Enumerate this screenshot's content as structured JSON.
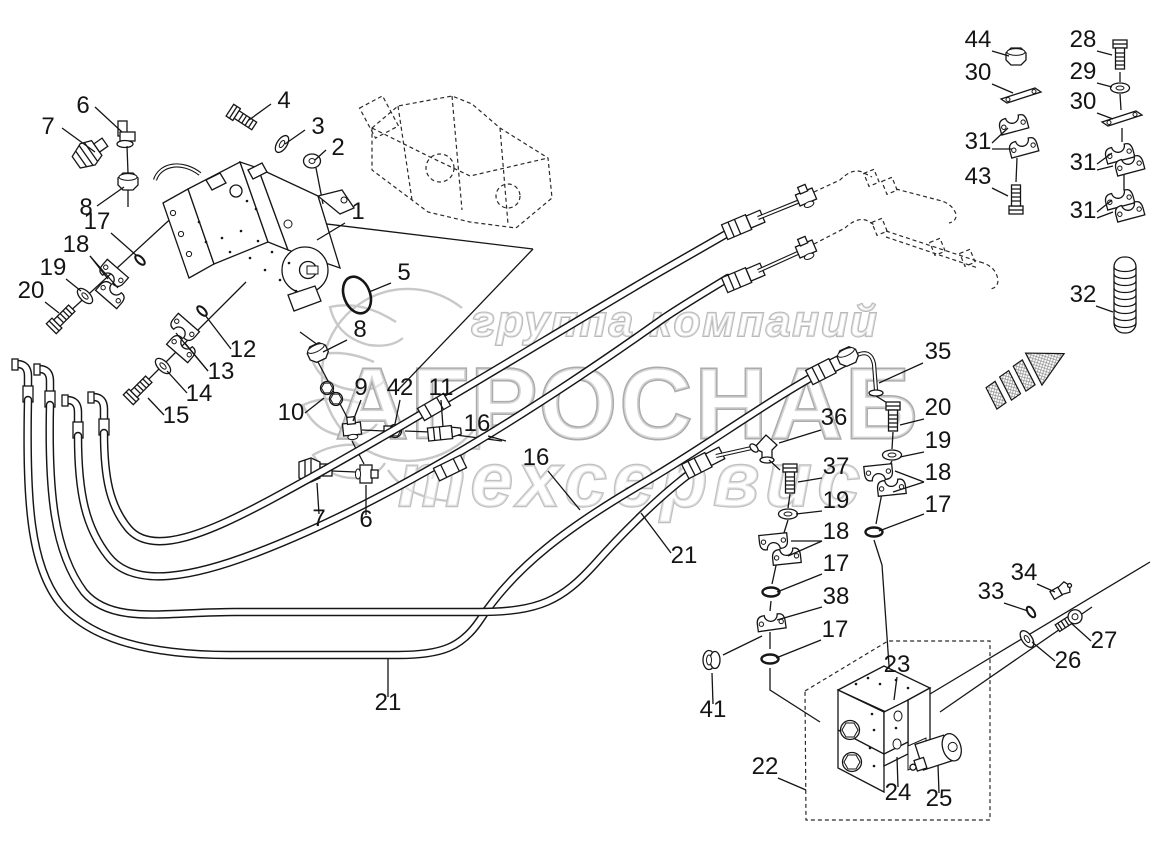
{
  "watermark": {
    "line1": "группа компаний",
    "line2": "АГРОСНАБ",
    "line3": "техсервис",
    "logo_icon": "wheat-gear-logo",
    "color": "#bdbdbd"
  },
  "diagram": {
    "background": "#ffffff",
    "line_color": "#161616",
    "direction_arrow_icon": "hatched-arrow-up-right",
    "callouts": [
      {
        "label": "7",
        "x": 48,
        "y": 134,
        "leaders": [
          [
            [
              62,
              128
            ],
            [
              95,
              152
            ]
          ]
        ]
      },
      {
        "label": "6",
        "x": 83,
        "y": 113,
        "leaders": [
          [
            [
              95,
              107
            ],
            [
              122,
              132
            ]
          ]
        ]
      },
      {
        "label": "4",
        "x": 284,
        "y": 108,
        "leaders": [
          [
            [
              271,
              104
            ],
            [
              249,
              120
            ]
          ]
        ]
      },
      {
        "label": "3",
        "x": 318,
        "y": 134,
        "leaders": [
          [
            [
              305,
              130
            ],
            [
              285,
              144
            ]
          ]
        ]
      },
      {
        "label": "2",
        "x": 338,
        "y": 155,
        "leaders": [
          [
            [
              326,
              150
            ],
            [
              315,
              160
            ]
          ]
        ]
      },
      {
        "label": "8",
        "x": 86,
        "y": 215,
        "leaders": [
          [
            [
              97,
              206
            ],
            [
              124,
              187
            ]
          ]
        ]
      },
      {
        "label": "17",
        "x": 97,
        "y": 229,
        "leaders": [
          [
            [
              111,
              233
            ],
            [
              137,
              256
            ]
          ]
        ]
      },
      {
        "label": "18",
        "x": 76,
        "y": 252,
        "leaders": [
          [
            [
              90,
              256
            ],
            [
              108,
              279
            ]
          ],
          [
            [
              90,
              256
            ],
            [
              118,
              288
            ]
          ]
        ]
      },
      {
        "label": "19",
        "x": 53,
        "y": 275,
        "leaders": [
          [
            [
              66,
              279
            ],
            [
              81,
              291
            ]
          ]
        ]
      },
      {
        "label": "20",
        "x": 31,
        "y": 298,
        "leaders": [
          [
            [
              45,
              302
            ],
            [
              59,
              313
            ]
          ]
        ]
      },
      {
        "label": "1",
        "x": 358,
        "y": 219,
        "leaders": [
          [
            [
              345,
              223
            ],
            [
              317,
              240
            ]
          ]
        ]
      },
      {
        "label": "5",
        "x": 404,
        "y": 280,
        "leaders": [
          [
            [
              391,
              283
            ],
            [
              369,
              292
            ]
          ]
        ]
      },
      {
        "label": "8",
        "x": 360,
        "y": 337,
        "leaders": [
          [
            [
              347,
              340
            ],
            [
              323,
              352
            ]
          ]
        ]
      },
      {
        "label": "12",
        "x": 243,
        "y": 357,
        "leaders": [
          [
            [
              231,
              349
            ],
            [
              205,
              315
            ]
          ]
        ]
      },
      {
        "label": "13",
        "x": 221,
        "y": 379,
        "leaders": [
          [
            [
              208,
              371
            ],
            [
              185,
              343
            ]
          ],
          [
            [
              208,
              371
            ],
            [
              176,
              333
            ]
          ]
        ]
      },
      {
        "label": "14",
        "x": 199,
        "y": 401,
        "leaders": [
          [
            [
              187,
              393
            ],
            [
              167,
              371
            ]
          ]
        ]
      },
      {
        "label": "15",
        "x": 176,
        "y": 423,
        "leaders": [
          [
            [
              164,
              415
            ],
            [
              148,
              398
            ]
          ]
        ]
      },
      {
        "label": "10",
        "x": 291,
        "y": 420,
        "leaders": [
          [
            [
              305,
              413
            ],
            [
              324,
              398
            ]
          ]
        ]
      },
      {
        "label": "9",
        "x": 361,
        "y": 395,
        "leaders": [
          [
            [
              361,
              400
            ],
            [
              353,
              421
            ]
          ]
        ]
      },
      {
        "label": "42",
        "x": 400,
        "y": 395,
        "leaders": [
          [
            [
              400,
              400
            ],
            [
              395,
              424
            ]
          ]
        ]
      },
      {
        "label": "11",
        "x": 441,
        "y": 395,
        "leaders": [
          [
            [
              441,
              400
            ],
            [
              443,
              427
            ]
          ]
        ]
      },
      {
        "label": "16",
        "x": 477,
        "y": 431,
        "leaders": [
          [
            [
              488,
              436
            ],
            [
              506,
              441
            ]
          ]
        ]
      },
      {
        "label": "16",
        "x": 536,
        "y": 465,
        "leaders": [
          [
            [
              548,
              471
            ],
            [
              580,
              510
            ]
          ]
        ]
      },
      {
        "label": "7",
        "x": 319,
        "y": 526,
        "leaders": [
          [
            [
              319,
              514
            ],
            [
              317,
              483
            ]
          ]
        ]
      },
      {
        "label": "6",
        "x": 366,
        "y": 527,
        "leaders": [
          [
            [
              366,
              515
            ],
            [
              366,
              485
            ]
          ]
        ]
      },
      {
        "label": "21",
        "x": 684,
        "y": 563,
        "leaders": [
          [
            [
              671,
              553
            ],
            [
              641,
              513
            ]
          ]
        ]
      },
      {
        "label": "21",
        "x": 388,
        "y": 710,
        "leaders": [
          [
            [
              388,
              697
            ],
            [
              388,
              659
            ]
          ]
        ]
      },
      {
        "label": "35",
        "x": 938,
        "y": 359,
        "leaders": [
          [
            [
              923,
              363
            ],
            [
              879,
              383
            ]
          ]
        ]
      },
      {
        "label": "36",
        "x": 834,
        "y": 425,
        "leaders": [
          [
            [
              821,
              430
            ],
            [
              779,
              443
            ]
          ]
        ]
      },
      {
        "label": "20",
        "x": 938,
        "y": 415,
        "leaders": [
          [
            [
              924,
              419
            ],
            [
              900,
              425
            ]
          ]
        ]
      },
      {
        "label": "19",
        "x": 938,
        "y": 448,
        "leaders": [
          [
            [
              924,
              452
            ],
            [
              900,
              457
            ]
          ]
        ]
      },
      {
        "label": "18",
        "x": 938,
        "y": 480,
        "leaders": [
          [
            [
              924,
              482
            ],
            [
              895,
              471
            ]
          ],
          [
            [
              924,
              482
            ],
            [
              893,
              492
            ]
          ]
        ]
      },
      {
        "label": "17",
        "x": 938,
        "y": 512,
        "leaders": [
          [
            [
              924,
              514
            ],
            [
              879,
              531
            ]
          ]
        ]
      },
      {
        "label": "37",
        "x": 836,
        "y": 474,
        "leaders": [
          [
            [
              822,
              478
            ],
            [
              798,
              482
            ]
          ]
        ]
      },
      {
        "label": "19",
        "x": 836,
        "y": 508,
        "leaders": [
          [
            [
              822,
              511
            ],
            [
              796,
              514
            ]
          ]
        ]
      },
      {
        "label": "18",
        "x": 836,
        "y": 539,
        "leaders": [
          [
            [
              822,
              541
            ],
            [
              791,
              541
            ]
          ],
          [
            [
              822,
              541
            ],
            [
              788,
              556
            ]
          ]
        ]
      },
      {
        "label": "17",
        "x": 836,
        "y": 571,
        "leaders": [
          [
            [
              822,
              574
            ],
            [
              777,
              592
            ]
          ]
        ]
      },
      {
        "label": "38",
        "x": 836,
        "y": 604,
        "leaders": [
          [
            [
              822,
              607
            ],
            [
              777,
              620
            ]
          ]
        ]
      },
      {
        "label": "17",
        "x": 835,
        "y": 637,
        "leaders": [
          [
            [
              821,
              640
            ],
            [
              776,
              658
            ]
          ]
        ]
      },
      {
        "label": "41",
        "x": 713,
        "y": 717,
        "leaders": [
          [
            [
              713,
              704
            ],
            [
              712,
              673
            ]
          ]
        ]
      },
      {
        "label": "22",
        "x": 765,
        "y": 774,
        "leaders": [
          [
            [
              778,
              778
            ],
            [
              806,
              790
            ]
          ]
        ]
      },
      {
        "label": "23",
        "x": 897,
        "y": 672,
        "leaders": [
          [
            [
              897,
              677
            ],
            [
              894,
              700
            ]
          ]
        ]
      },
      {
        "label": "24",
        "x": 898,
        "y": 800,
        "leaders": [
          [
            [
              898,
              787
            ],
            [
              897,
              757
            ]
          ]
        ]
      },
      {
        "label": "25",
        "x": 939,
        "y": 806,
        "leaders": [
          [
            [
              939,
              793
            ],
            [
              938,
              765
            ]
          ]
        ]
      },
      {
        "label": "33",
        "x": 991,
        "y": 599,
        "leaders": [
          [
            [
              1004,
              603
            ],
            [
              1028,
              611
            ]
          ]
        ]
      },
      {
        "label": "34",
        "x": 1024,
        "y": 580,
        "leaders": [
          [
            [
              1037,
              584
            ],
            [
              1055,
              592
            ]
          ]
        ]
      },
      {
        "label": "27",
        "x": 1104,
        "y": 648,
        "leaders": [
          [
            [
              1091,
              641
            ],
            [
              1071,
              623
            ]
          ]
        ]
      },
      {
        "label": "26",
        "x": 1068,
        "y": 668,
        "leaders": [
          [
            [
              1055,
              661
            ],
            [
              1032,
              642
            ]
          ]
        ]
      },
      {
        "label": "44",
        "x": 978,
        "y": 47,
        "leaders": [
          [
            [
              992,
              51
            ],
            [
              1009,
              56
            ]
          ]
        ]
      },
      {
        "label": "30",
        "x": 978,
        "y": 80,
        "leaders": [
          [
            [
              992,
              84
            ],
            [
              1013,
              93
            ]
          ]
        ]
      },
      {
        "label": "31",
        "x": 978,
        "y": 149,
        "leaders": [
          [
            [
              992,
              143
            ],
            [
              1008,
              128
            ]
          ],
          [
            [
              992,
              149
            ],
            [
              1012,
              149
            ]
          ]
        ]
      },
      {
        "label": "43",
        "x": 978,
        "y": 184,
        "leaders": [
          [
            [
              992,
              188
            ],
            [
              1008,
              196
            ]
          ]
        ]
      },
      {
        "label": "28",
        "x": 1083,
        "y": 47,
        "leaders": [
          [
            [
              1097,
              51
            ],
            [
              1112,
              55
            ]
          ]
        ]
      },
      {
        "label": "29",
        "x": 1083,
        "y": 79,
        "leaders": [
          [
            [
              1097,
              83
            ],
            [
              1112,
              87
            ]
          ]
        ]
      },
      {
        "label": "30",
        "x": 1083,
        "y": 109,
        "leaders": [
          [
            [
              1097,
              113
            ],
            [
              1113,
              119
            ]
          ]
        ]
      },
      {
        "label": "31",
        "x": 1083,
        "y": 170,
        "leaders": [
          [
            [
              1097,
              164
            ],
            [
              1112,
              153
            ]
          ],
          [
            [
              1097,
              170
            ],
            [
              1113,
              166
            ]
          ]
        ]
      },
      {
        "label": "31",
        "x": 1083,
        "y": 218,
        "leaders": [
          [
            [
              1097,
              212
            ],
            [
              1112,
              200
            ]
          ],
          [
            [
              1097,
              218
            ],
            [
              1113,
              212
            ]
          ]
        ]
      },
      {
        "label": "32",
        "x": 1083,
        "y": 302,
        "leaders": [
          [
            [
              1096,
              306
            ],
            [
              1113,
              312
            ]
          ]
        ]
      }
    ]
  }
}
